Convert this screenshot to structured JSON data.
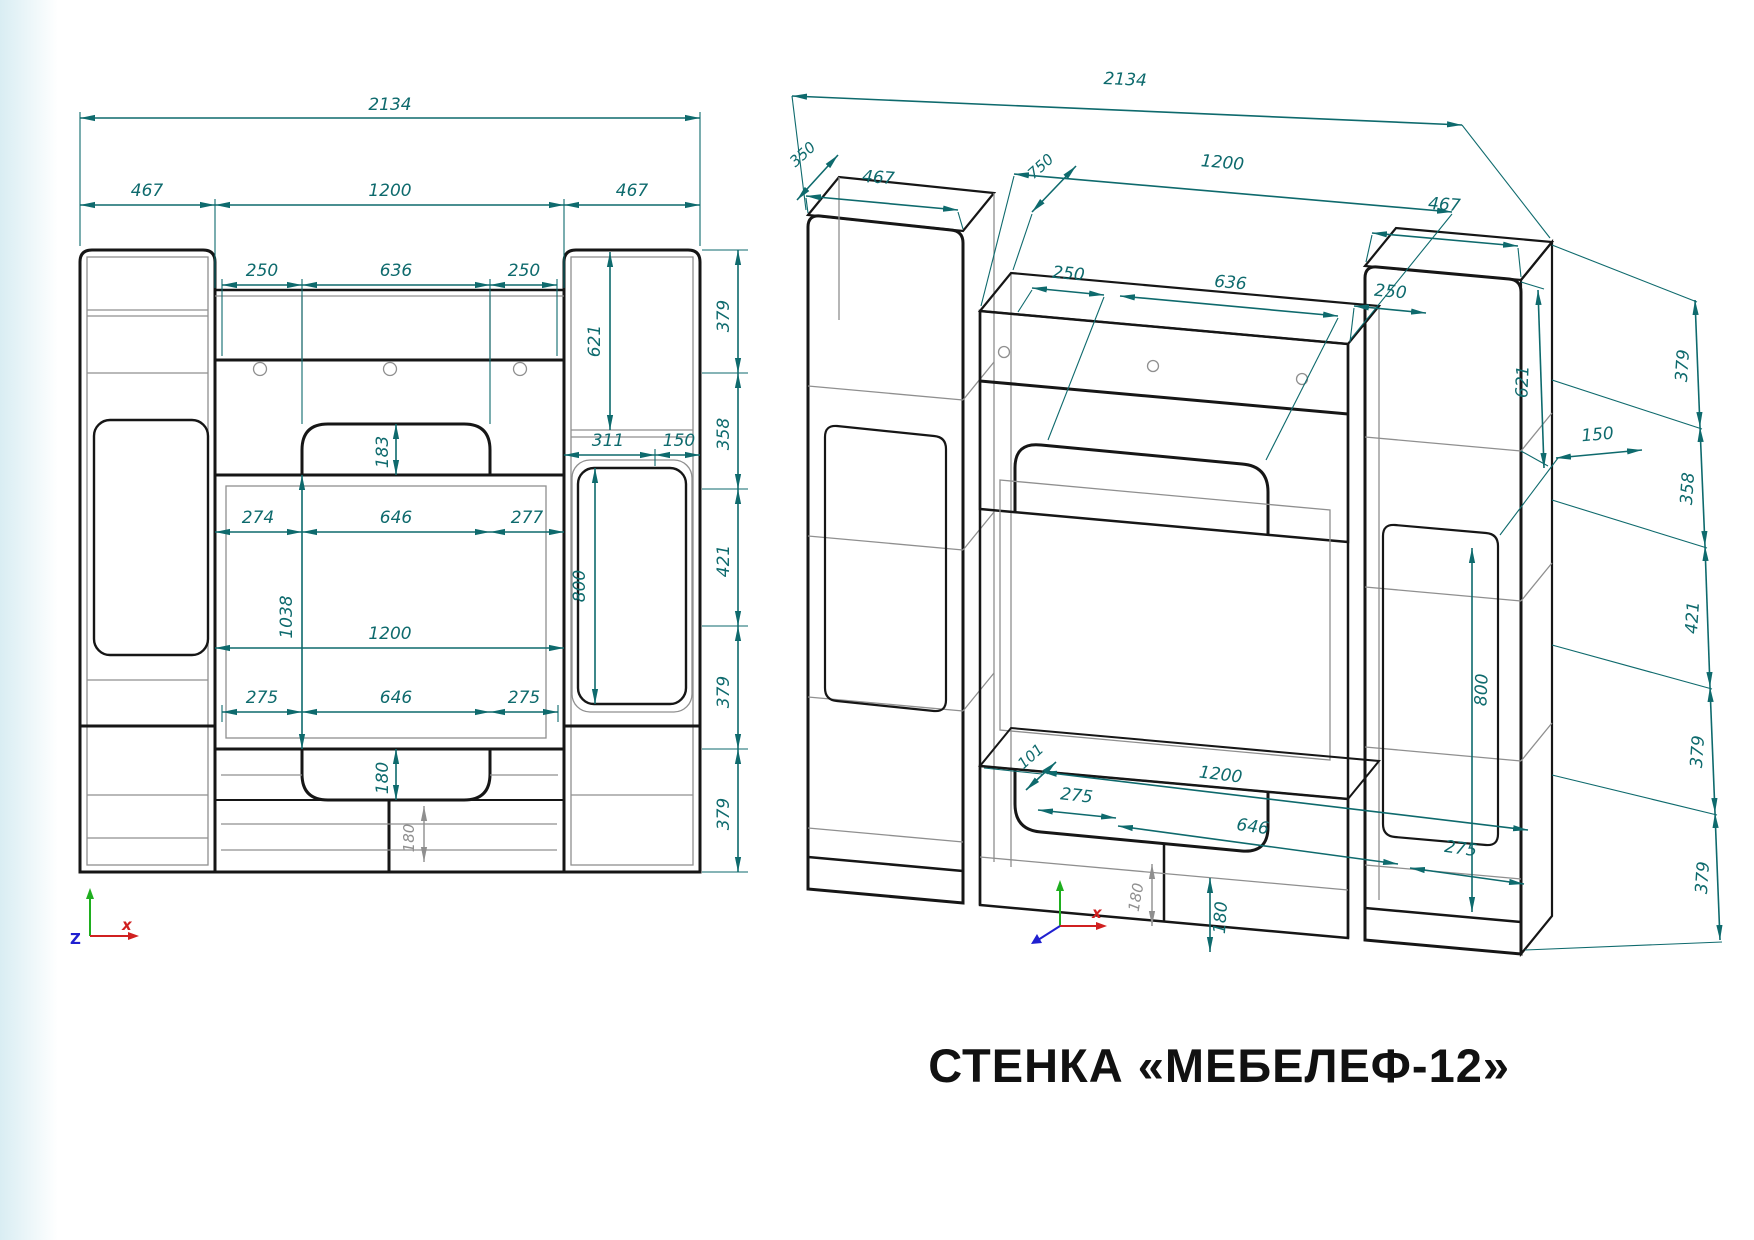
{
  "title": "СТЕНКА «МЕБЕЛЕФ-12»",
  "colors": {
    "dimension": "#0e6a6d",
    "outline": "#161616",
    "thin_line": "#8f8f8f",
    "axis_x": "#d02020",
    "axis_y": "#1fae1f",
    "axis_z": "#2020d0",
    "background": "#ffffff"
  },
  "front_view": {
    "dims": {
      "overall_width": "2134",
      "left_width": "467",
      "center_width": "1200",
      "right_width": "467",
      "shelf_left_inset": "250",
      "shelf_niche": "636",
      "shelf_right_inset": "250",
      "shelf_arch_height": "183",
      "right_top_height": "621",
      "right_door_width": "311",
      "right_edge_inset": "150",
      "niche_left_inset": "274",
      "niche_width": "646",
      "niche_right_inset": "277",
      "opening_height": "1038",
      "door_height": "800",
      "opening_width": "1200",
      "stand_left_inset": "275",
      "stand_niche": "646",
      "stand_right_inset": "275",
      "stand_arch_height": "180",
      "base_height": "180",
      "height_segments": [
        "379",
        "358",
        "421",
        "379",
        "379"
      ]
    },
    "axes": {
      "x": "x",
      "z": "Z"
    }
  },
  "iso_view": {
    "dims": {
      "overall_width": "2134",
      "depth": "350",
      "left_width": "467",
      "inner_depth": "750",
      "center_width": "1200",
      "right_width": "467",
      "shelf_left_inset": "250",
      "shelf_niche": "636",
      "shelf_right_inset": "250",
      "right_top_height": "621",
      "right_edge_inset": "150",
      "door_height": "800",
      "height_segments": [
        "379",
        "358",
        "421",
        "379",
        "379"
      ],
      "base_offset": "101",
      "stand_left_inset": "275",
      "opening_width": "1200",
      "stand_niche": "646",
      "stand_right_inset": "275",
      "stand_arch_height": "180",
      "base_height": "180"
    },
    "axes": {
      "x": "x"
    }
  }
}
